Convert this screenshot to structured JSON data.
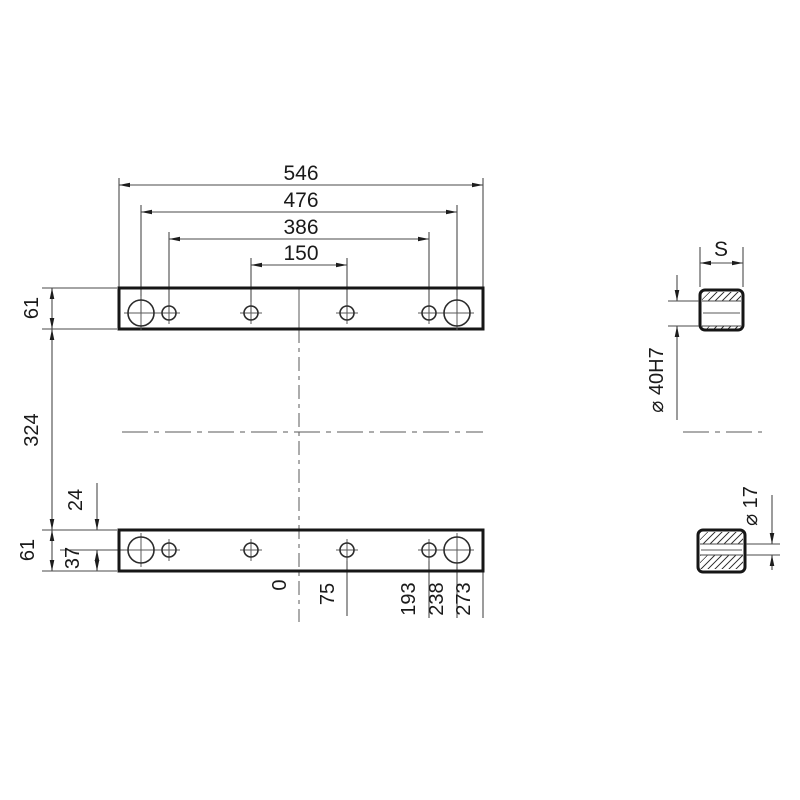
{
  "dims": {
    "top": [
      "546",
      "476",
      "386",
      "150"
    ],
    "left": {
      "top_bar_height": "61",
      "bars_gap": "324",
      "top_hole_offset": "24",
      "bottom_bar_height": "61",
      "bottom_hole_offset": "37"
    },
    "ordinates": [
      "0",
      "75",
      "193",
      "238",
      "273"
    ],
    "section": {
      "width": "S",
      "large_bore": "⌀ 40H7",
      "small_bore": "⌀ 17"
    }
  }
}
